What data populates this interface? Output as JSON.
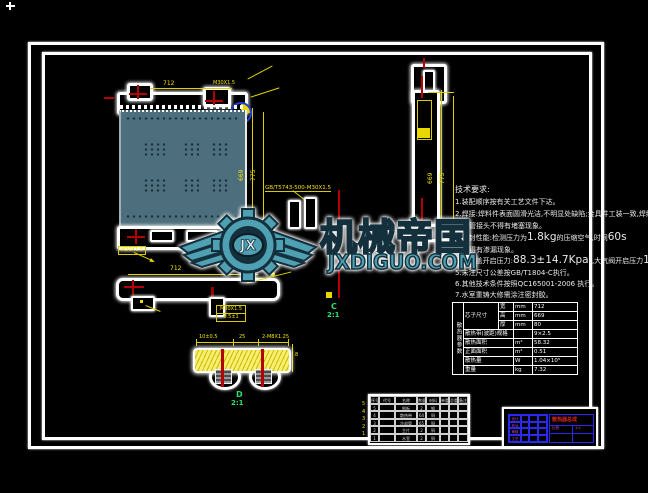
{
  "colors": {
    "background": "#000000",
    "frame": "#ffffff",
    "core_fill": "#4d6e7c",
    "dimension_yellow": "#f0e400",
    "centerline_red": "#b40000",
    "section_green": "#2ce06a",
    "watermark_teal": "#4fa0b2",
    "titleblock_blue": "#2a2aee",
    "titleblock_magenta": "#cc44cc",
    "titleblock_red": "#e02424"
  },
  "watermark": {
    "brand": "机械帝国",
    "domain": "JXDIGUO.COM",
    "monogram": "JX"
  },
  "tech": {
    "title": "技术要求:",
    "l1": "1.装配顺序按有关工艺文件下达。",
    "l2": "2.焊接:焊料件表面圆滑光洁,不明显处缺陷;金具件工装一致,焊缝均匀;",
    "l3": "水管接头不得有堵塞现象。",
    "l4_pre": "3.密封性能:检测压力为",
    "l4_big1": "1.8kg",
    "l4_mid": "的压缩空气,时间",
    "l4_big2": "60s",
    "l5": "不得有渗漏现象。",
    "l6_pre": "4.水口盖开启压力:",
    "l6_big1": "88.3±14.7Kpa.",
    "l6_mid": ",大气阀开启压力",
    "l6_big2": "1.98-11.76Kpa",
    "l7": "5.未注尺寸公差按GB/T1804-C执行。",
    "l8": "6.其他技术条件按照QC165001-2006 执行。",
    "l9": "7.水室重铸大修需涂注密封胶。"
  },
  "param_table": {
    "side_header": "散热器参数",
    "core_label": "芯子尺寸",
    "rows_core": [
      {
        "sub": "宽",
        "unit": "mm",
        "value": "712"
      },
      {
        "sub": "高",
        "unit": "mm",
        "value": "669"
      },
      {
        "sub": "厚",
        "unit": "mm",
        "value": "80"
      }
    ],
    "rows": [
      {
        "label": "散热带(波距)规格",
        "unit": "",
        "value": "9×2.5"
      },
      {
        "label": "散热面积",
        "unit": "m²",
        "value": "58.32"
      },
      {
        "label": "正面面积",
        "unit": "m²",
        "value": "0.51"
      },
      {
        "label": "散热量",
        "unit": "W",
        "value": "1.04×10⁵"
      },
      {
        "label": "重量",
        "unit": "kg",
        "value": "7.32"
      }
    ]
  },
  "bom": {
    "header": [
      "序号",
      "代号",
      "名称",
      "数量",
      "材料",
      "单重",
      "总重",
      "备注"
    ],
    "rows": [
      [
        "5",
        "",
        "侧板",
        "2",
        "钢",
        "",
        "",
        ""
      ],
      [
        "4",
        "",
        "散热带",
        "64",
        "铜",
        "",
        "",
        ""
      ],
      [
        "3",
        "",
        "冷却管",
        "65",
        "铜",
        "",
        "",
        ""
      ],
      [
        "2",
        "",
        "主片",
        "2",
        "铜",
        "",
        "",
        ""
      ],
      [
        "1",
        "",
        "水室",
        "2",
        "铜",
        "",
        "",
        ""
      ]
    ],
    "row_numbers": [
      "5",
      "4",
      "3",
      "2",
      "1"
    ]
  },
  "title_block": {
    "fields": [
      "设计",
      "校对",
      "审核",
      "工艺"
    ],
    "name": "散热器总成",
    "scale_label": "比例",
    "scale": "1:2"
  },
  "labels": {
    "dim_top_width": "712",
    "dim_top_thread": "M30X1.5",
    "dim_core_height": "669",
    "dim_core_height2": "775",
    "leader_spec": "GB/T5743-500-M30X1.5",
    "tank_label": "M30X1.5",
    "bottom_length": "712",
    "bottom_label_line1": "M30X1.5",
    "bottom_label_line2": "8.5±1",
    "side_dim1": "669",
    "side_dim2": "775",
    "detail_dim1": "10±0.5",
    "detail_dim2": "25",
    "detail_dim3": "2-M8X1.25",
    "detail_dim4": "8",
    "section_c": "C",
    "section_d": "D",
    "scale_2_1": "2:1"
  }
}
